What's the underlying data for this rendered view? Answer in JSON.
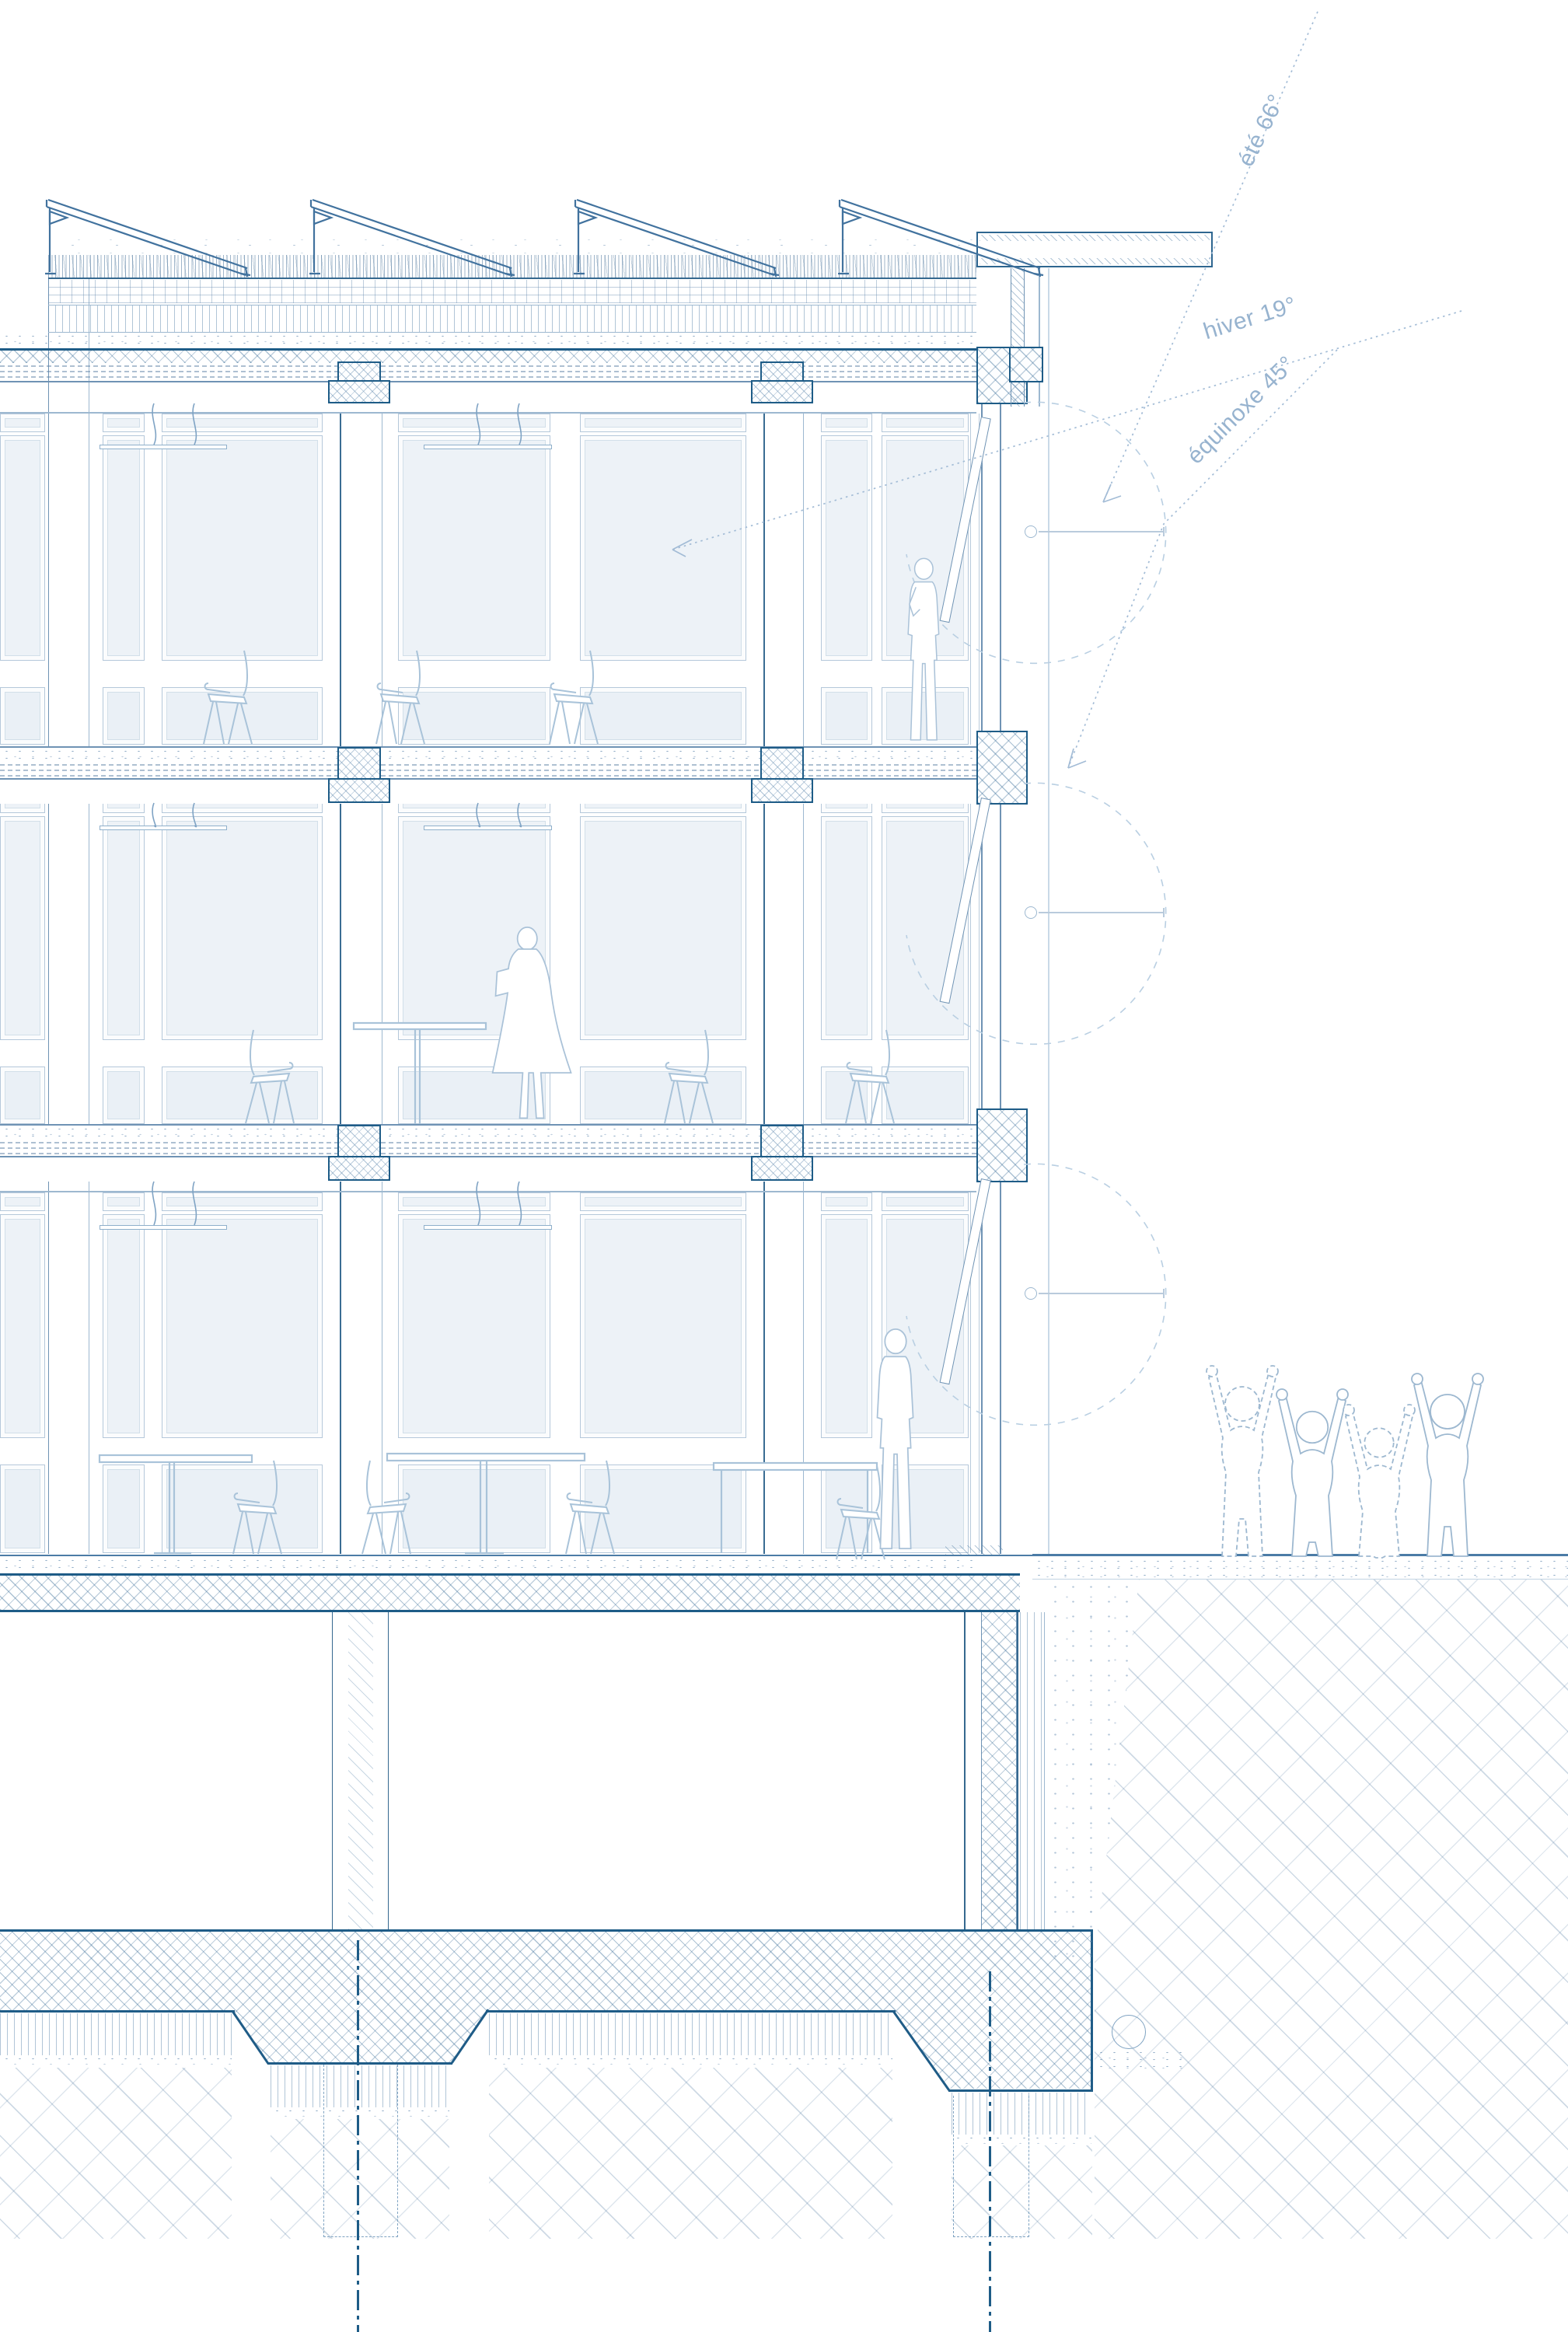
{
  "annotations": {
    "summer": {
      "label": "été 66°",
      "angle_deg": 66
    },
    "winter": {
      "label": "hiver 19°",
      "angle_deg": 19
    },
    "equinox": {
      "label": "équinoxe 45°",
      "angle_deg": 45
    }
  },
  "scene": {
    "type": "architectural cross-section (sun-study diagram)",
    "floors_above_ground": 3,
    "basement": true,
    "roof": "green roof with tilted photovoltaic panels and wildflower meadow",
    "facade": "right-hand glazed facade with external louver flaps shown open (dashed swing arcs)",
    "ground": "excavation backfill and undisturbed earth hatch at right, raft foundation with piles below",
    "people": [
      "man standing at window, top floor",
      "woman standing, middle floor",
      "man standing at table, ground floor",
      "group of cheering children outside at grade"
    ],
    "furniture": [
      "chairs",
      "pedestal tables",
      "pendant lights"
    ]
  },
  "palette": {
    "line_dark": "#1e5c87",
    "line_mid": "#6f93b4",
    "line_light": "#a9c3d9",
    "pane_fill": "#edf2f7",
    "label_text": "#97b3cf",
    "background": "#ffffff"
  }
}
